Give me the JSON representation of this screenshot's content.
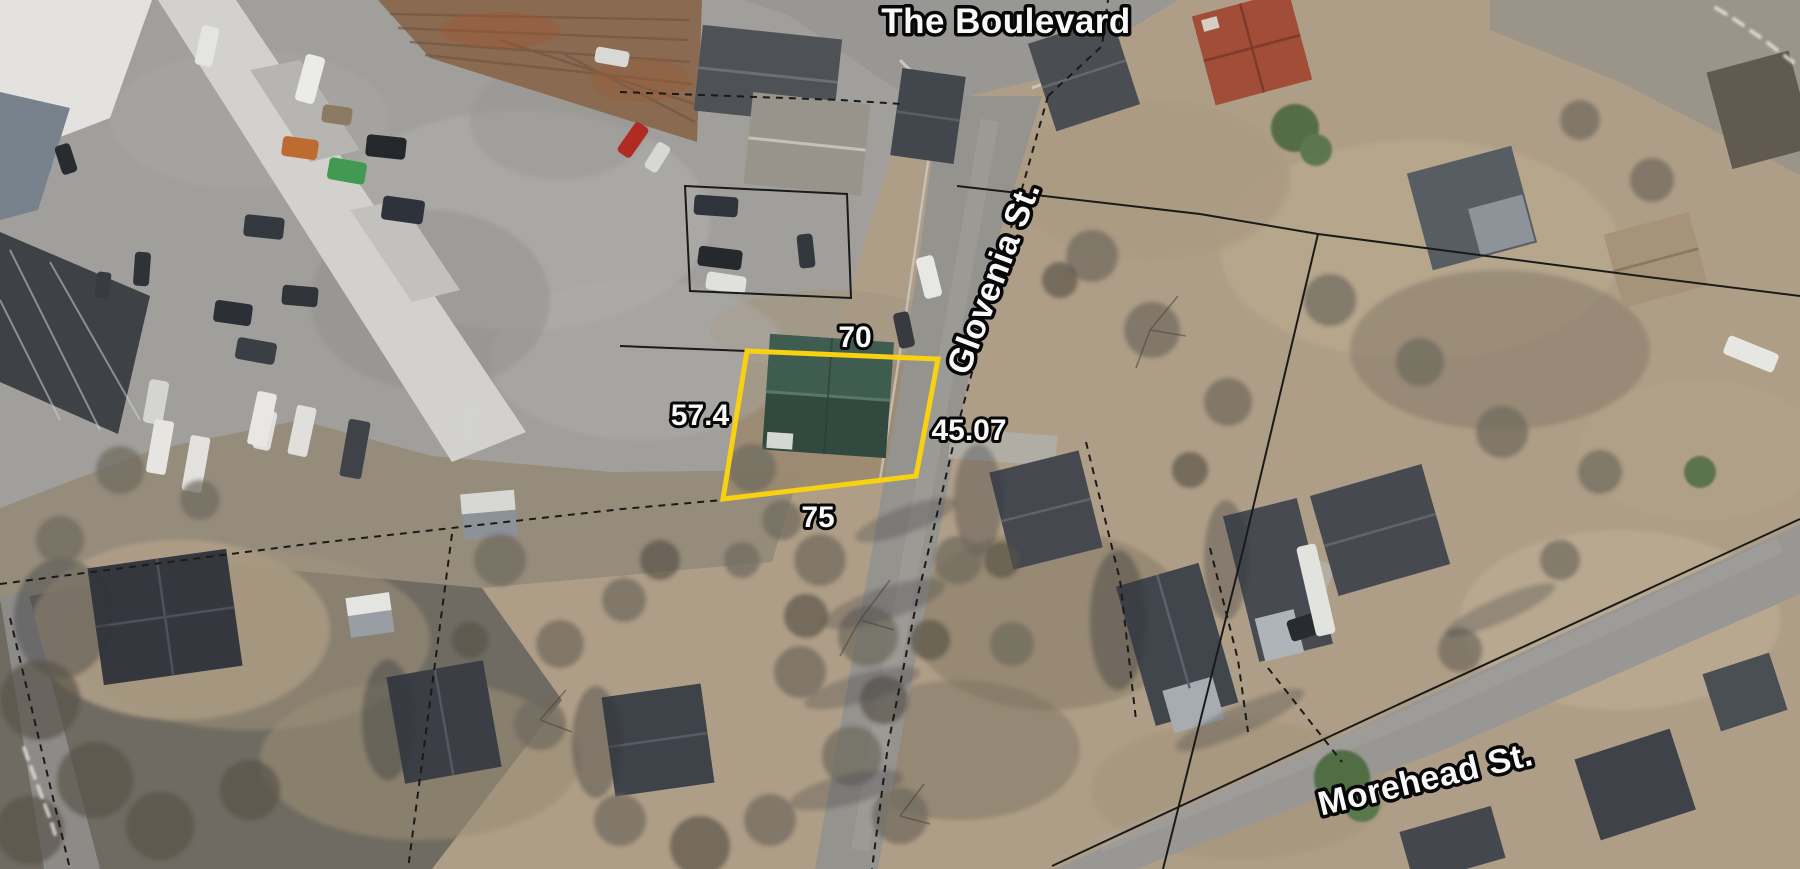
{
  "map": {
    "description": "Aerial GIS parcel map with highlighted property",
    "street_labels": {
      "the_boulevard": "The Boulevard",
      "glovenia": "Glovenia St.",
      "morehead": "Morehead St."
    },
    "highlighted_parcel": {
      "outline_color": "#FFD60A",
      "dimension_labels": {
        "north": "70",
        "west": "57.4",
        "east": "45.07",
        "south": "75"
      }
    },
    "boundary_color": "#141414",
    "label_style": {
      "text_color": "#FFFFFF",
      "outline_color": "#000000"
    }
  }
}
